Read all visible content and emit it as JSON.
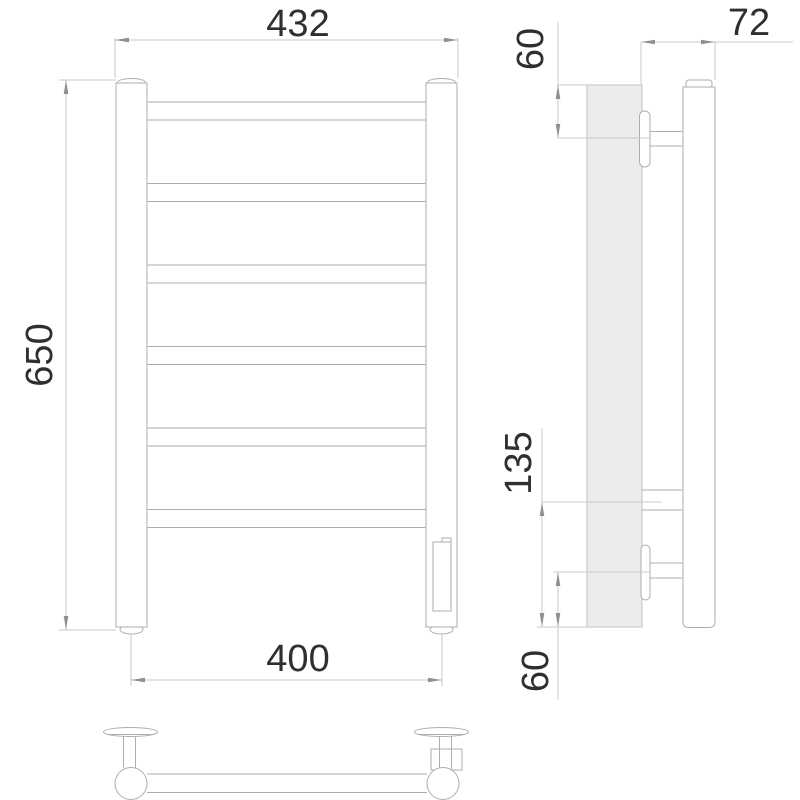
{
  "drawing": {
    "type": "technical-drawing",
    "subject": "ladder towel rail, three orthographic views",
    "dimensions": {
      "overall_width": "432",
      "depth": "72",
      "top_bracket_offset": "60",
      "overall_height": "650",
      "lower_connection_offset": "135",
      "bottom_bracket_offset": "60",
      "mounting_width": "400"
    },
    "colors": {
      "geometry_line": "#aeaeae",
      "dimension_line": "#c9c9c9",
      "text": "#2f2f2f",
      "wall_panel_fill": "#ececec",
      "background": "#ffffff"
    }
  }
}
